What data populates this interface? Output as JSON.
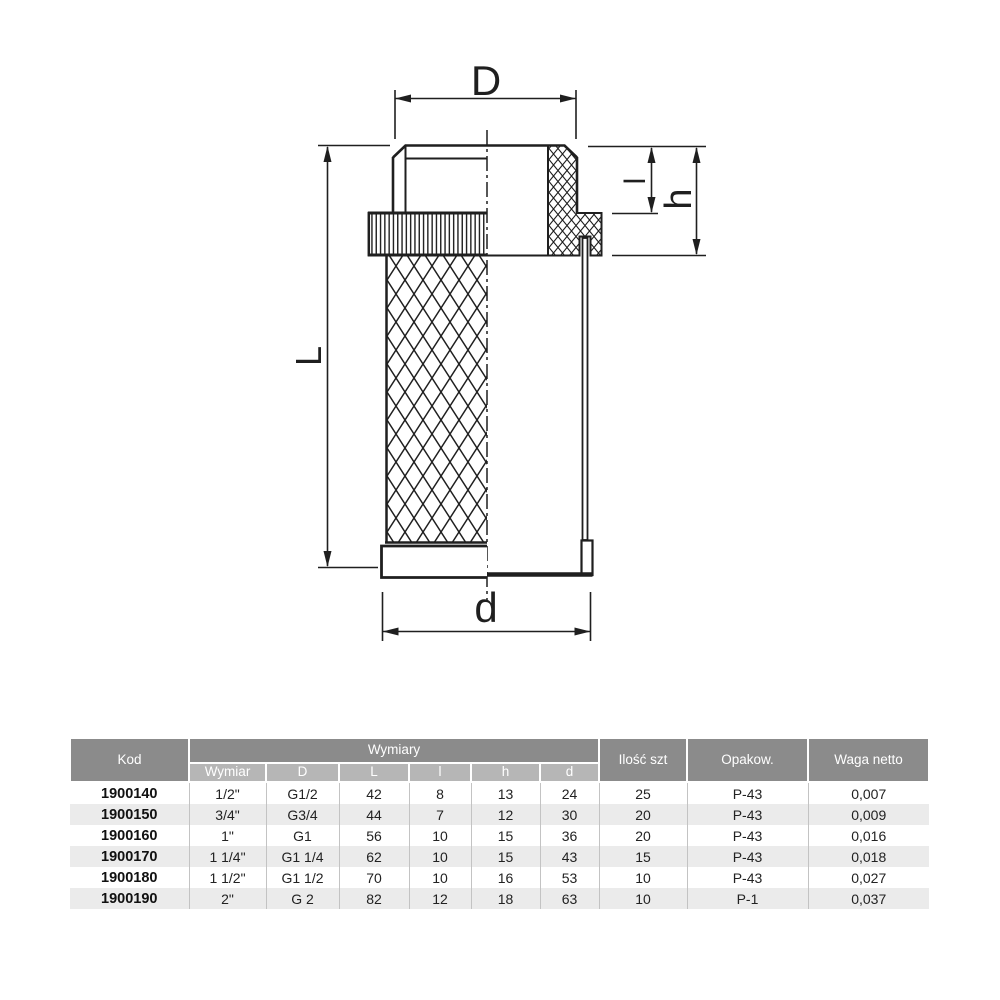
{
  "drawing": {
    "labels": {
      "D": "D",
      "L": "L",
      "d": "d",
      "l": "l",
      "h": "h"
    },
    "line_color": "#1f1f1f"
  },
  "table": {
    "colors": {
      "header_bg": "#8b8b8b",
      "subheader_bg": "#b6b6b6",
      "alt_row_bg": "#ebebeb",
      "header_text": "#ffffff"
    },
    "header": {
      "kod": "Kod",
      "wymiary": "Wymiary",
      "ilosc": "Ilość szt",
      "opakow": "Opakow.",
      "waga": "Waga netto"
    },
    "subheader": [
      "Wymiar",
      "D",
      "L",
      "l",
      "h",
      "d"
    ],
    "rows": [
      [
        "1900140",
        "1/2\"",
        "G1/2",
        "42",
        "8",
        "13",
        "24",
        "25",
        "P-43",
        "0,007"
      ],
      [
        "1900150",
        "3/4\"",
        "G3/4",
        "44",
        "7",
        "12",
        "30",
        "20",
        "P-43",
        "0,009"
      ],
      [
        "1900160",
        "1\"",
        "G1",
        "56",
        "10",
        "15",
        "36",
        "20",
        "P-43",
        "0,016"
      ],
      [
        "1900170",
        "1 1/4\"",
        "G1 1/4",
        "62",
        "10",
        "15",
        "43",
        "15",
        "P-43",
        "0,018"
      ],
      [
        "1900180",
        "1 1/2\"",
        "G1 1/2",
        "70",
        "10",
        "16",
        "53",
        "10",
        "P-43",
        "0,027"
      ],
      [
        "1900190",
        "2\"",
        "G 2",
        "82",
        "12",
        "18",
        "63",
        "10",
        "P-1",
        "0,037"
      ]
    ]
  }
}
